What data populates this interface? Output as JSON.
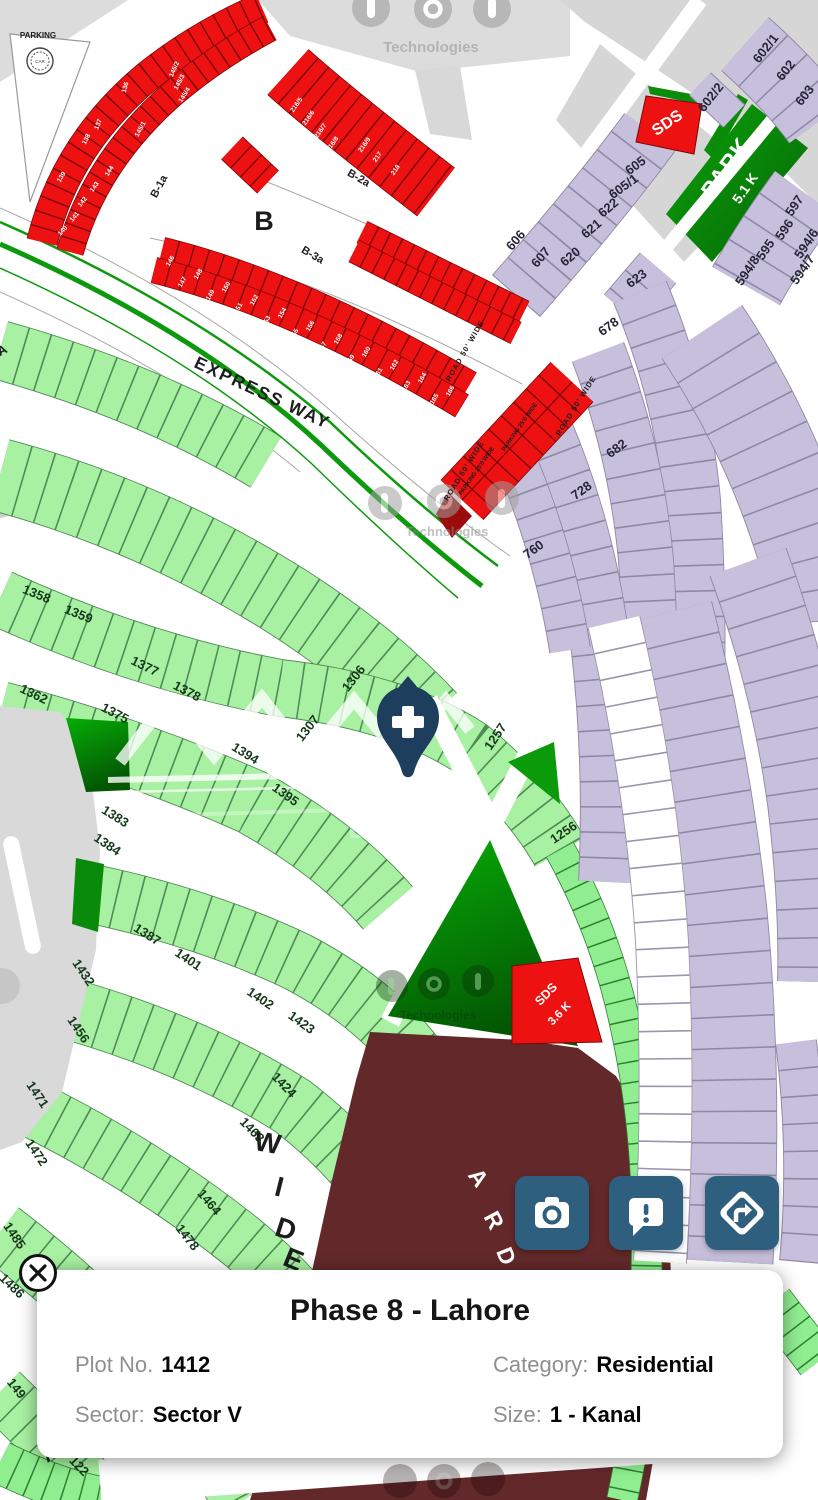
{
  "colors": {
    "plot_red": "#ee1111",
    "plot_light_green": "#a9f1a2",
    "plot_bright_green": "#90ee90",
    "plot_dark_green": "#0a9a0a",
    "plot_purple": "#c7c0dc",
    "boulevard_maroon": "#63292a",
    "action_button": "#2e5f7e",
    "pin": "#1d3e5c"
  },
  "watermarks": {
    "brand": "Technologies",
    "dha": "DHA Plus"
  },
  "map": {
    "street_labels": {
      "b1a": "B-1a",
      "b": "B",
      "b2a": "B-2a",
      "b3a": "B-3a",
      "express_way": "EXPRESS WAY",
      "road50": "ROAD 50' WIDE",
      "parking25": "PARKING 25'0 WIDE",
      "parking": "PARKING",
      "car": "CAR",
      "wide_w": "W",
      "wide_i": "I",
      "wide_d": "D",
      "wide_e": "E",
      "street_a": "A",
      "street_a2": "A",
      "blvd_a": "A",
      "blvd_r": "R",
      "blvd_d": "D"
    },
    "area_labels": {
      "park": "PARK",
      "park_size": "5.1 K",
      "sds": "SDS",
      "sds_size": "3.6 K"
    },
    "green_plots": [
      "1358",
      "1359",
      "1362",
      "1375",
      "1377",
      "1378",
      "1383",
      "1384",
      "1387",
      "1394",
      "1395",
      "1401",
      "1402",
      "1423",
      "1424",
      "1432",
      "1456",
      "1463",
      "1464",
      "1471",
      "1472",
      "1478",
      "1485",
      "1486",
      "1306",
      "1307",
      "1257",
      "1256",
      "149",
      "122"
    ],
    "purple_plots": [
      "602/1",
      "602",
      "603",
      "602/2",
      "605",
      "605/1",
      "606",
      "607",
      "620",
      "621",
      "622",
      "623",
      "678",
      "682",
      "728",
      "760",
      "597",
      "596",
      "595",
      "594/8",
      "594/6",
      "594/7"
    ],
    "red_plots": [
      "136",
      "137",
      "138",
      "139",
      "140",
      "141",
      "142",
      "143",
      "144",
      "145/1",
      "145/2",
      "145/3",
      "145/4",
      "145/5",
      "146",
      "147",
      "148",
      "149",
      "150",
      "151",
      "152",
      "153",
      "154",
      "155",
      "156",
      "157",
      "158",
      "159",
      "160",
      "161",
      "162",
      "163",
      "164",
      "165",
      "166",
      "216/5",
      "216/6",
      "216/7",
      "216/8",
      "216/9",
      "217",
      "218"
    ]
  },
  "info_card": {
    "title": "Phase 8 - Lahore",
    "fields": {
      "plot_label": "Plot No.",
      "plot_value": "1412",
      "category_label": "Category:",
      "category_value": "Residential",
      "sector_label": "Sector:",
      "sector_value": "Sector V",
      "size_label": "Size:",
      "size_value": "1 - Kanal"
    }
  }
}
